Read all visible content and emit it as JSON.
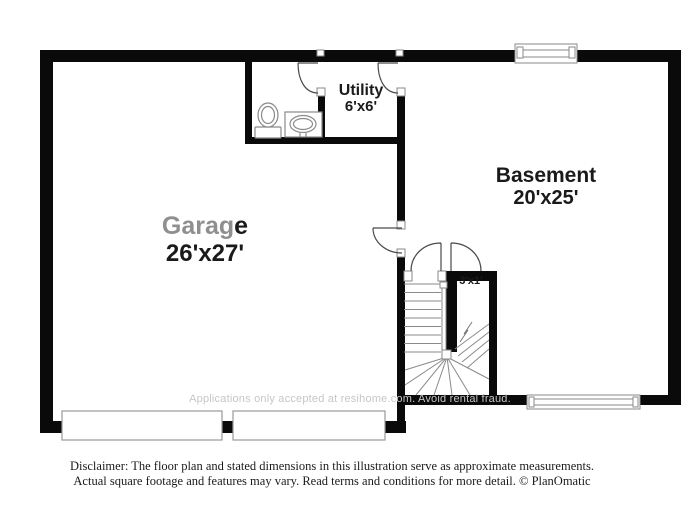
{
  "plan": {
    "rooms": [
      {
        "name": "Garage",
        "name_gray_part": "Garag",
        "name_dark_part": "e",
        "dims": "26'x27'"
      },
      {
        "name": "Basement",
        "dims": "20'x25'"
      },
      {
        "name": "Utility",
        "dims": "6'x6'"
      },
      {
        "dims": "3'x1'"
      }
    ],
    "watermark": "Applications only accepted at resihome.com. Avoid rental fraud.",
    "icons": [
      "toilet-icon",
      "sink-icon",
      "stairs",
      "window",
      "garage-door",
      "door-swing"
    ],
    "colors": {
      "wall": "#0a0a0a",
      "door_arc": "#4a4a4a",
      "fixture_outline": "#8a8a8a",
      "label": "#1a1a1a",
      "label_gray": "#8f8f8f",
      "watermark": "#c6c6c6"
    }
  },
  "footer": {
    "disclaimer_line1": "Disclaimer: The floor plan and stated dimensions in this illustration serve as approximate measurements.",
    "disclaimer_line2": "Actual square footage and features may vary. Read terms and conditions for more detail. © PlanOmatic"
  }
}
